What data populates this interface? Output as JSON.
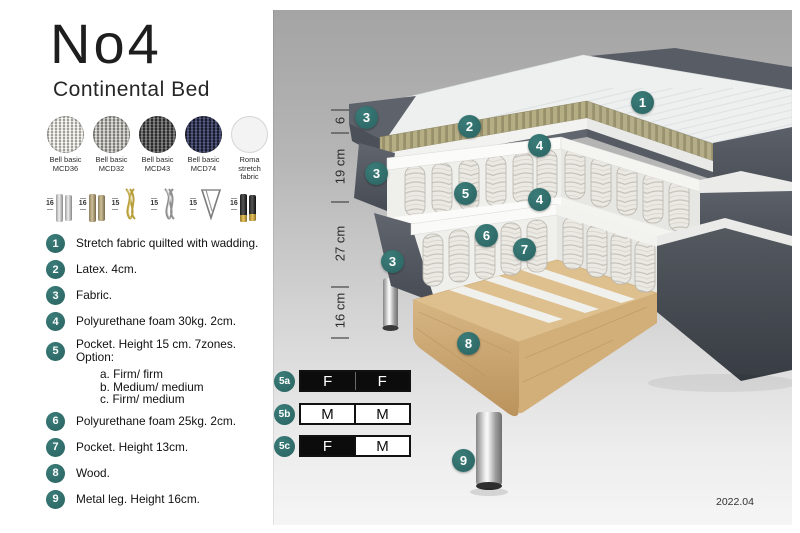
{
  "product": {
    "title": "No4",
    "subtitle": "Continental Bed",
    "version": "2022.04"
  },
  "fabric_swatches": [
    {
      "line1": "Bell basic",
      "line2": "MCD36"
    },
    {
      "line1": "Bell basic",
      "line2": "MCD32"
    },
    {
      "line1": "Bell basic",
      "line2": "MCD43"
    },
    {
      "line1": "Bell basic",
      "line2": "MCD74"
    },
    {
      "line1": "Roma",
      "line2": "stretch fabric"
    }
  ],
  "leg_options": [
    {
      "height": "16",
      "type": "cylinder-silver"
    },
    {
      "height": "16",
      "type": "cylinder-wood"
    },
    {
      "height": "15",
      "type": "twisted-gold"
    },
    {
      "height": "15",
      "type": "twisted-silver"
    },
    {
      "height": "15",
      "type": "hairpin"
    },
    {
      "height": "16",
      "type": "black-gold"
    }
  ],
  "features": [
    {
      "num": "1",
      "text": "Stretch fabric quilted with wadding."
    },
    {
      "num": "2",
      "text": "Latex. 4cm."
    },
    {
      "num": "3",
      "text": "Fabric."
    },
    {
      "num": "4",
      "text": "Polyurethane foam 30kg. 2cm."
    },
    {
      "num": "5",
      "text": "Pocket. Height 15 cm. 7zones. Option:",
      "options": [
        "a. Firm/ firm",
        "b. Medium/ medium",
        "c. Firm/ medium"
      ]
    },
    {
      "num": "6",
      "text": "Polyurethane foam 25kg. 2cm."
    },
    {
      "num": "7",
      "text": "Pocket. Height 13cm."
    },
    {
      "num": "8",
      "text": "Wood."
    },
    {
      "num": "9",
      "text": "Metal leg. Height 16cm."
    }
  ],
  "diagram": {
    "measurements": [
      "6",
      "19 cm",
      "27 cm",
      "16 cm"
    ],
    "badges": [
      "1",
      "2",
      "3",
      "4",
      "3",
      "5",
      "4",
      "6",
      "7",
      "3",
      "8",
      "9"
    ],
    "firmness_options": [
      {
        "id": "5a",
        "cells": [
          {
            "label": "F",
            "style": "dark"
          },
          {
            "label": "F",
            "style": "dark"
          }
        ]
      },
      {
        "id": "5b",
        "cells": [
          {
            "label": "M",
            "style": "light"
          },
          {
            "label": "M",
            "style": "light"
          }
        ]
      },
      {
        "id": "5c",
        "cells": [
          {
            "label": "F",
            "style": "dark"
          },
          {
            "label": "M",
            "style": "light"
          }
        ]
      }
    ]
  },
  "colors": {
    "badge_teal": "#2d6b69",
    "firmness_dark": "#0c0c0c",
    "panel_gray_top": "#a4a4a4",
    "panel_gray_bottom": "#f5f5f5",
    "wood": "#debf8e",
    "latex": "#b5ad84",
    "fabric_dark_gray": "#565b63"
  }
}
